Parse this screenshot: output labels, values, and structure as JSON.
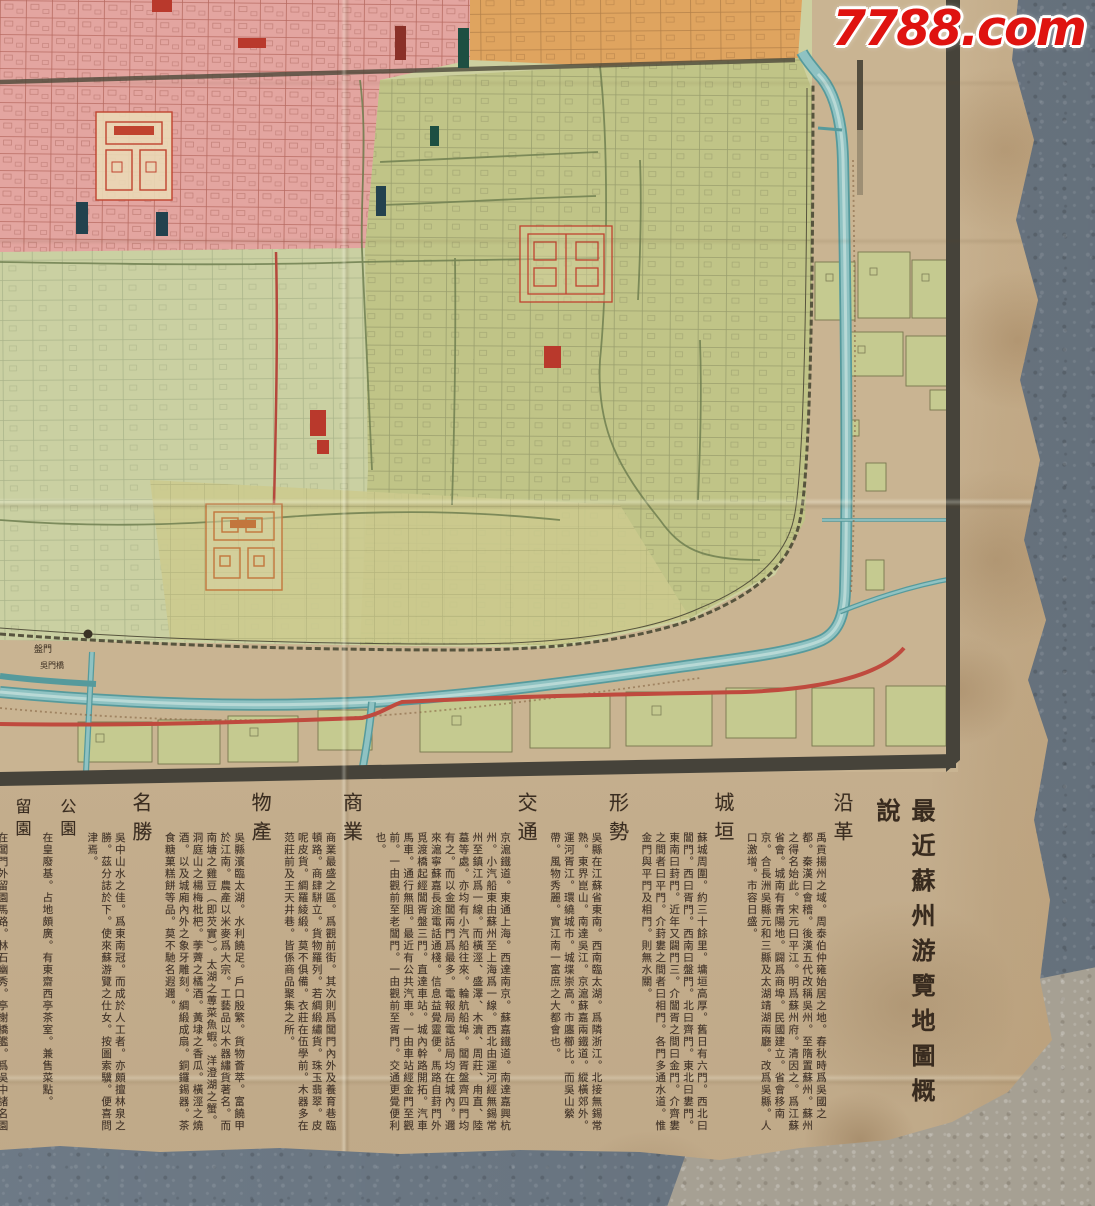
{
  "watermark": {
    "text": "7788.com",
    "color": "#df1310"
  },
  "photo": {
    "floor_dark_color": "#73808d",
    "floor_light_color": "#a6a093",
    "paper_color": "#c7b190"
  },
  "map": {
    "labels": {
      "panmen_gate": "盤門",
      "wumen_bridge": "吳門橋"
    },
    "colors": {
      "district_pink": "#e3a5a0",
      "district_orange": "#dfa45f",
      "district_green": "#c0c487",
      "district_celadon": "#cad0a2",
      "canal_blue": "#8fc2c2",
      "road_red": "#bf4a3e",
      "wall_dark": "#57543e",
      "compound_red": "#c0432f",
      "border_dark": "#46433a"
    }
  },
  "text_panel": {
    "title": "最近蘇州游覽地圖概說",
    "sections": [
      {
        "title": "沿革",
        "body": "禹貢揚州之域。周泰伯仲雍始居之地。春秋時爲吳國之都。秦漢曰會稽。後漢五代改稱吳州。至隋置蘇州。蘇州之得名始此。宋元曰平江。明爲蘇州府。清因之。爲江蘇省會。城南有青陽地。闢爲商埠。民國建立。省會移南京。合長洲吳縣元和三縣及太湖靖湖兩廳。改爲吳縣。人口激增。市容日盛。"
      },
      {
        "title": "城垣",
        "body": "蘇城周圍。約三十餘里。墉垣高厚。舊日有六門。西北曰閶門。西曰胥門。西南曰盤門。北曰齊門。東北曰婁門。東南曰葑門。近年又闢門三。介閶胥之間曰金門。介齊婁之間者曰平門。介葑婁之間者曰相門。各門多通水道。惟金門與平門及相門。則無水關。"
      },
      {
        "title": "形勢",
        "body": "吳縣在江蘇省東南。西南臨太湖。爲隣浙江。北接無錫常熟。東界崑山。南達吳江。京滬蘇嘉兩鐵道。縱橫郊外。運河胥江。環繞城市。城堞崇高。市廛櫛比。而吳山縈帶。風物秀麗。實江南一富庶之大都會也。"
      },
      {
        "title": "交通",
        "body": "京滬鐵道。東通上海。西達南京。蘇嘉鐵道。南達嘉興杭州。小汽船東由蘇州至上海爲一線。西北由運河經無錫常州至鎮江爲一線。而橫涇、盛澤、木瀆、周莊、甪直、陸墓等處。亦均有小汽船往來。輪航船埠。閶胥盤齊四門均有之。而以金閶兩門爲最多。電報局電話局均在城內。邇來滬寧蘇嘉長途電話通棧。信息益覺靈便。馬路自葑門外覓渡橋起經閶胥盤三門。直達車站。城內幹路開拓。汽車馬車。通行無阻。最近有公共汽車。一由車站經金門至觀前。一由觀前至老閶門。一由觀前至胥門。交通更覺便利也。"
      },
      {
        "title": "商業",
        "body": "商業最盛之區。爲觀前街。其次則爲閶門內外及養育巷臨頓路。商肆駢立。貨物羅列。若綢緞繡貨。珠玉翡翠。皮呢皮貨。綢羅綾緞。莫不俱備。衣莊在伍學前。木器多在范莊前及王天井巷。皆係商品聚集之所。"
      },
      {
        "title": "物產",
        "body": "吳縣濱臨太湖。水利饒足。戶口殷繁。貨物薈萃。富饒甲於江南。農產以米麥爲大宗。工藝品以木器繡貨著名。而南塘之雞豆（即芡實）。太湖之蓴菜魚蝦。洋澄湖之蟹。洞庭山之楊梅枇杷。荸薺之橘酒。黃埭之香瓜。橫涇之燒酒。以及城廂內外之象牙雕刻。綢緞成扇。銅鑼錫器。茶食糖菓糕餅等品。莫不馳名遐邇。"
      },
      {
        "title": "名勝",
        "body": "吳中山水之佳。爲東南冠。而成於人工者。亦頗擅林泉之勝。茲分誌於下。使來蘇游覽之仕女。按圖索驥。便喜問津焉。"
      },
      {
        "title": "公園",
        "body": "在皇廢基。占地頗廣。有東齋西亭茶室。兼售菜點。"
      },
      {
        "title": "留園",
        "body": "在閶門外留園馬路。林石幽秀。亭榭橋艦。爲吳中諸名園之冠。"
      },
      {
        "title": "西園",
        "body": "位於留園之西。即西園戒幢寺之放生池。園中以放生池爲勝景。上架曲橋。中有湖心亭。頗壯觀。"
      },
      {
        "title": "北寺塔",
        "body": "在護龍街北。報恩寺前。塔凡九級。極壯麗。爲吳都浮屠之冠。"
      },
      {
        "title": "獅子林",
        "body": "在婁門內潘儒巷中。湖石玲瓏。洞壑宛轉。相傳爲畫師倪雲林所構。游其中者。如入迷陣。"
      }
    ]
  }
}
